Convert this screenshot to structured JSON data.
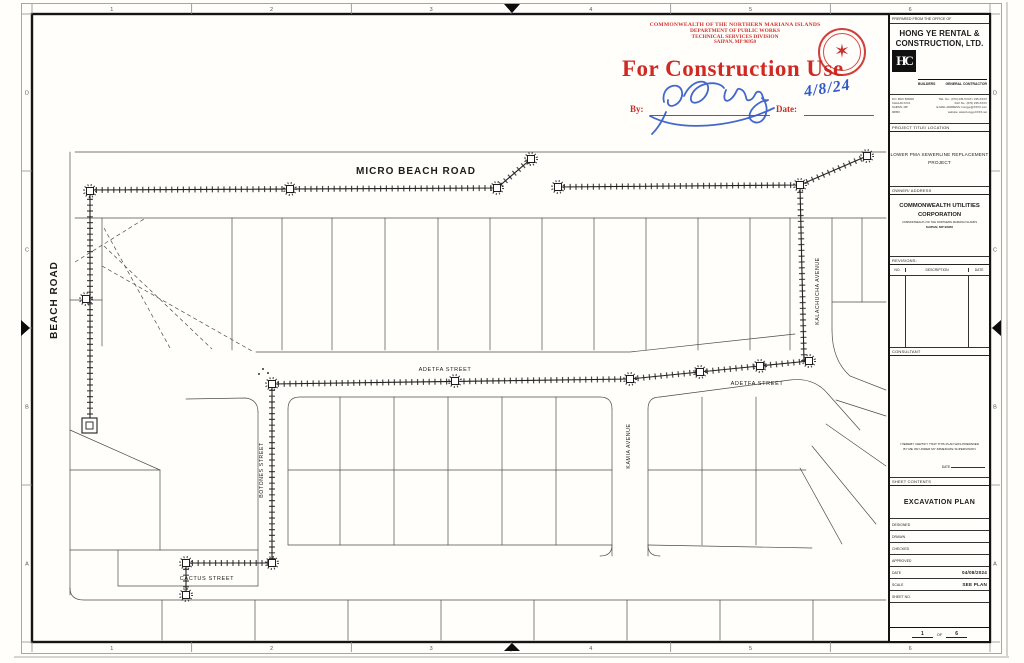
{
  "page": {
    "paper_color": "#fffefb",
    "line_color": "#2a2a2a",
    "stamp_color": "#cc211a",
    "signature_color": "#2f58c8"
  },
  "stamp": {
    "agency_lines": [
      "COMMONWEALTH OF THE NORTHERN MARIANA ISLANDS",
      "DEPARTMENT OF PUBLIC WORKS",
      "TECHNICAL SERVICES DIVISION",
      "SAIPAN, MP 96950"
    ],
    "title": "For Construction Use",
    "by_label": "By:",
    "date_label": "Date:",
    "date_value": "4/8/24"
  },
  "plan": {
    "streets": {
      "micro_beach_road": "MICRO BEACH ROAD",
      "beach_road": "BEACH ROAD",
      "adetfa_street_west": "ADETFA STREET",
      "adetfa_street_east": "ADETFA STREET",
      "kalachucha_avenue": "KALACHUCHA AVENUE",
      "kamia_avenue": "KAMIA AVENUE",
      "botones_street": "BOTONES STREET",
      "cactus_street": "CACTUS STREET"
    }
  },
  "titleblock": {
    "prepared_label": "PREPARED FROM THE OFFICE OF",
    "company_name_line1": "HONG YE RENTAL &",
    "company_name_line2": "CONSTRUCTION, LTD.",
    "logo_text": "HC",
    "builders_label": "BUILDERS",
    "contractor_label": "GENERAL CONTRACTOR",
    "address_left": [
      "P.O. BOX 500640",
      "CHALAN KIYA",
      "SAIPAN, MP",
      "96950"
    ],
    "address_right": [
      "TEL. No.: (670) 235-XXXX / 235-XXXX",
      "FAX No.: (670) 235-XXXX",
      "E-MAIL ADDRESS: hongye@XXXX.com",
      "website: www.hongyeXXXX.net"
    ],
    "project_title_label": "PROJECT TITLE/ LOCATION",
    "project_title_line1": "LOWER PMA SEWERLINE REPLACEMENT",
    "project_title_line2": "PROJECT",
    "owner_label": "OWNER/ ADDRESS",
    "owner_line1": "COMMONWEALTH UTILITIES",
    "owner_line2": "CORPORATION",
    "owner_line3": "COMMONWEALTH OF THE NORTHERN MARIANA ISLANDS",
    "owner_line4": "SAIPAN, MP 96950",
    "revisions_label": "REVISIONS:",
    "revision_columns": [
      "NO.",
      "DESCRIPTION",
      "DATE"
    ],
    "consultant_label": "CONSULTANT",
    "certification_line1": "I HEREBY CERTIFY THAT THIS PLAN WAS PREPARED",
    "certification_line2": "BY ME OR UNDER MY IMMEDIATE SUPERVISION",
    "certification_date_label": "DATE",
    "sheet_contents_label": "SHEET CONTENTS",
    "sheet_title": "EXCAVATION PLAN",
    "info_rows": [
      {
        "label": "DESIGNED",
        "value": ""
      },
      {
        "label": "DRAWN",
        "value": ""
      },
      {
        "label": "CHECKED",
        "value": ""
      },
      {
        "label": "APPROVED",
        "value": ""
      },
      {
        "label": "DATE",
        "value": "04/08/2024"
      },
      {
        "label": "SCALE",
        "value": "SEE PLAN"
      },
      {
        "label": "SHEET NO.",
        "value": ""
      }
    ],
    "sheet_number": "1",
    "sheet_of_label": "OF",
    "sheet_total": "6"
  },
  "border": {
    "column_labels": [
      "1",
      "2",
      "3",
      "4",
      "5",
      "6"
    ],
    "row_labels": [
      "D",
      "C",
      "B",
      "A"
    ]
  }
}
